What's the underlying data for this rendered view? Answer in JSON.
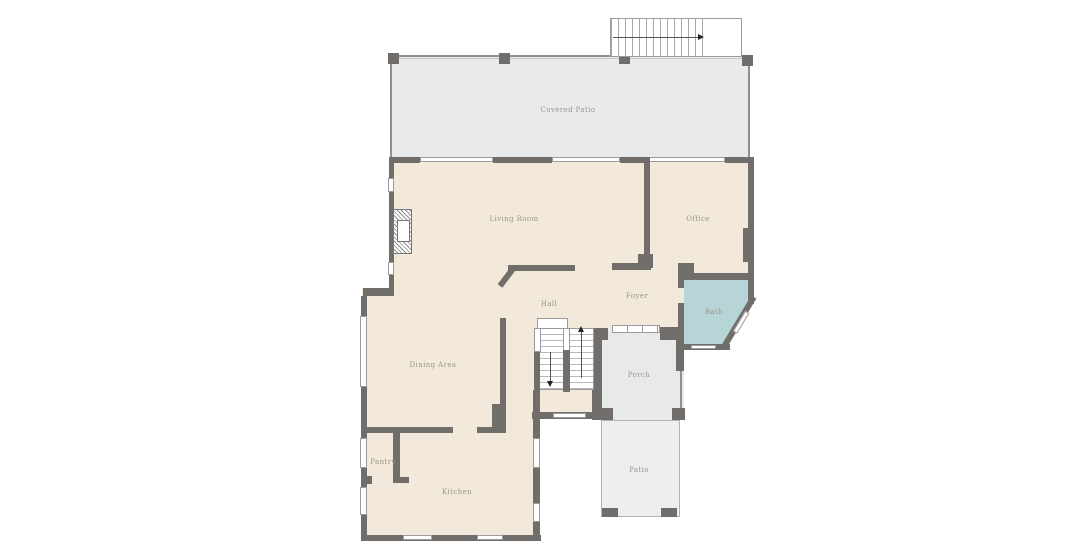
{
  "plan": {
    "rooms": {
      "covered_patio": {
        "label": "Covered Patio"
      },
      "living_room": {
        "label": "Living Room"
      },
      "office": {
        "label": "Office"
      },
      "hall": {
        "label": "Hall"
      },
      "foyer": {
        "label": "Foyer"
      },
      "bath": {
        "label": "Bath"
      },
      "dining_area": {
        "label": "Dining Area"
      },
      "pantry": {
        "label": "Pantry"
      },
      "kitchen": {
        "label": "Kitchen"
      },
      "porch": {
        "label": "Porch"
      },
      "patio": {
        "label": "Patio"
      }
    },
    "colors": {
      "background": "#ffffff",
      "wall": "#706d6a",
      "window": "#ffffff",
      "outline": "#9b9b9b",
      "label": "#9a958c",
      "interior_floor": "#f2e9da",
      "covered_patio_floor": "#e9eaeb",
      "bath_floor": "#b7d4d7",
      "porch_floor": "#e8eaea",
      "patio_floor": "#edeeee"
    }
  }
}
